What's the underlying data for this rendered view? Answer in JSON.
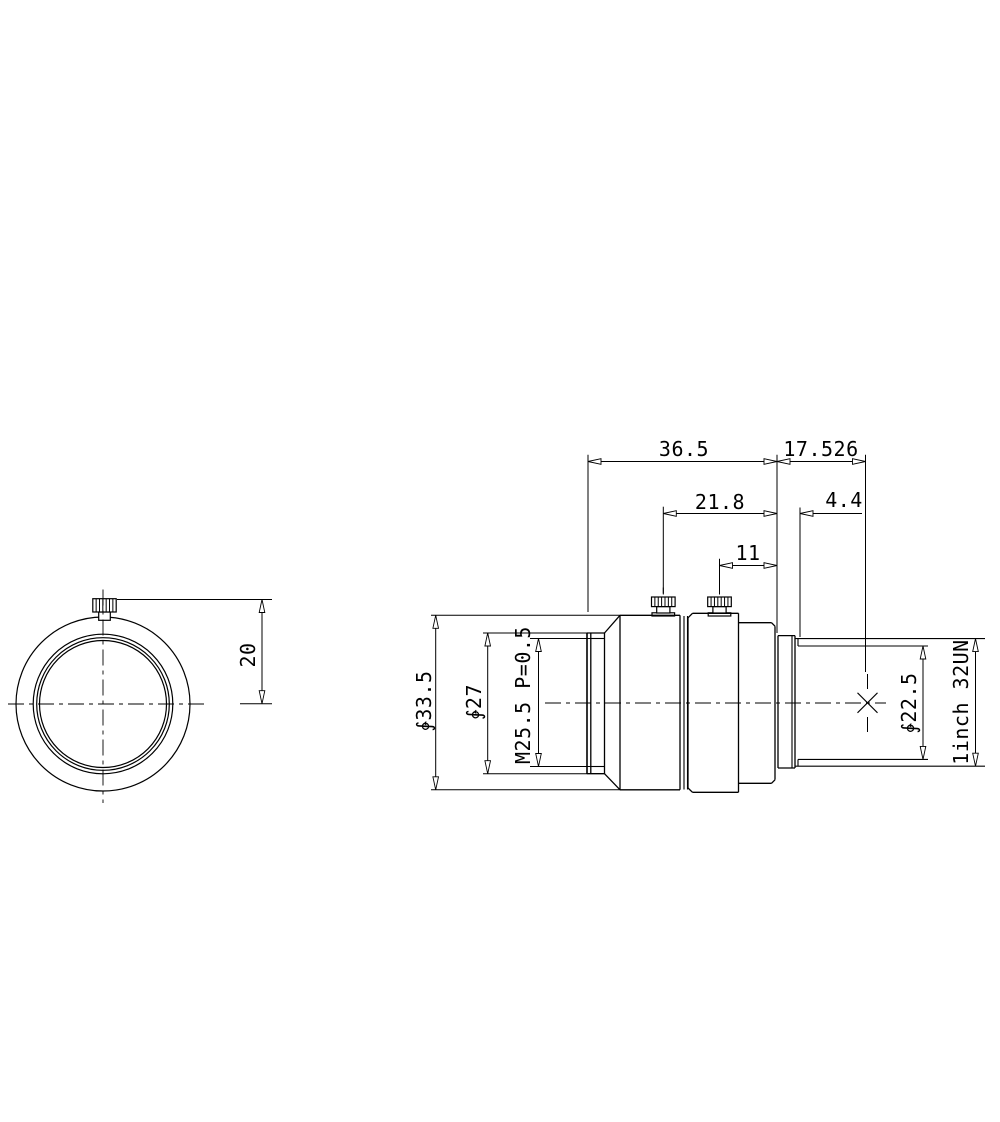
{
  "drawing": {
    "type": "lens mechanical drawing, front view and side view",
    "line_color": "#000000",
    "background": "#ffffff",
    "dimension_labels": [
      "36.5",
      "17.526",
      "21.8",
      "4.4",
      "11",
      "20",
      "∳33.5",
      "∳27",
      "M25.5 P=0.5",
      "∳22.5",
      "1inch 32UN"
    ]
  },
  "svg": {
    "circles": [
      {
        "n": "front-view-outer-rim-circle",
        "cx": 103,
        "cy": 704,
        "r": 87
      },
      {
        "n": "front-view-ring-circle",
        "cx": 103,
        "cy": 704,
        "r": 69.8
      },
      {
        "n": "front-view-thread-circle",
        "cx": 103,
        "cy": 704,
        "r": 66.3
      },
      {
        "n": "front-view-bore-circle",
        "cx": 103,
        "cy": 704,
        "r": 63.5
      }
    ],
    "rects": [
      {
        "n": "front-thumbscrew-neck",
        "x": 98.7,
        "y": 612,
        "w": 11.6,
        "h": 8.3
      },
      {
        "n": "front-thumbscrew-head",
        "x": 92.8,
        "y": 598.7,
        "w": 23.4,
        "h": 13.3,
        "knurl": 6
      },
      {
        "n": "side-thumbscrew1-washer",
        "x": 652,
        "y": 612.8,
        "w": 22.6,
        "h": 3.2
      },
      {
        "n": "side-thumbscrew1-neck",
        "x": 656.7,
        "y": 606.6,
        "w": 13.2,
        "h": 6.4
      },
      {
        "n": "side-thumbscrew1-head",
        "x": 651.5,
        "y": 597,
        "w": 23.6,
        "h": 9.6,
        "knurl": 6
      },
      {
        "n": "side-thumbscrew2-washer",
        "x": 708.2,
        "y": 612.8,
        "w": 22.6,
        "h": 3.2
      },
      {
        "n": "side-thumbscrew2-neck",
        "x": 712.9,
        "y": 606.6,
        "w": 13.2,
        "h": 6.4
      },
      {
        "n": "side-thumbscrew2-head",
        "x": 707.7,
        "y": 597,
        "w": 23.6,
        "h": 9.6,
        "knurl": 6
      }
    ],
    "lines": [
      {
        "n": "front-ring-face-outer",
        "x1": 587,
        "y1": 633,
        "x2": 587,
        "y2": 773.7,
        "w": 1.6
      },
      {
        "n": "front-ring-face-inner",
        "x1": 590.8,
        "y1": 633,
        "x2": 590.8,
        "y2": 773.7,
        "w": 1.3
      },
      {
        "n": "front-ring-right-edge",
        "x1": 604.5,
        "y1": 633,
        "x2": 604.5,
        "y2": 773.7,
        "w": 1.3
      },
      {
        "n": "front-ring-top-edge",
        "x1": 587,
        "y1": 633,
        "x2": 604.5,
        "y2": 633,
        "w": 1.3
      },
      {
        "n": "front-ring-bottom-edge",
        "x1": 587,
        "y1": 773.7,
        "x2": 604.5,
        "y2": 773.7,
        "w": 1.3
      },
      {
        "n": "filter-thread-top-line",
        "x1": 590.8,
        "y1": 638.5,
        "x2": 604.5,
        "y2": 638.5,
        "w": 1.1
      },
      {
        "n": "filter-thread-bottom-line",
        "x1": 590.8,
        "y1": 766.5,
        "x2": 604.5,
        "y2": 766.5,
        "w": 1.1
      },
      {
        "n": "cone-top-edge",
        "x1": 604.5,
        "y1": 633,
        "x2": 620,
        "y2": 615.3,
        "w": 1.3
      },
      {
        "n": "cone-bottom-edge",
        "x1": 604.5,
        "y1": 773.7,
        "x2": 620,
        "y2": 789.8,
        "w": 1.3
      },
      {
        "n": "barrel1-left-edge",
        "x1": 620,
        "y1": 615.3,
        "x2": 620,
        "y2": 789.8,
        "w": 1.3
      },
      {
        "n": "barrel1-top-edge",
        "x1": 620,
        "y1": 615.3,
        "x2": 680,
        "y2": 615.3,
        "w": 1.3
      },
      {
        "n": "barrel1-bottom-edge",
        "x1": 620,
        "y1": 789.8,
        "x2": 680,
        "y2": 789.8,
        "w": 1.3
      },
      {
        "n": "barrel1-right-edge",
        "x1": 680,
        "y1": 615.3,
        "x2": 680,
        "y2": 789.8,
        "w": 1.3
      },
      {
        "n": "mid-ring-left-line",
        "x1": 684,
        "y1": 616,
        "x2": 684,
        "y2": 789.5,
        "w": 1.1
      },
      {
        "n": "mid-ring-right-line",
        "x1": 687.5,
        "y1": 616,
        "x2": 687.5,
        "y2": 789.5,
        "w": 1.1
      },
      {
        "n": "barrel2-left-edge",
        "x1": 688,
        "y1": 617.8,
        "x2": 688,
        "y2": 788,
        "w": 1.3
      },
      {
        "n": "barrel2-chamfer-top-left",
        "x1": 688,
        "y1": 617.8,
        "x2": 692.5,
        "y2": 613.3,
        "w": 1.3
      },
      {
        "n": "barrel2-chamfer-bottom-left",
        "x1": 688,
        "y1": 788,
        "x2": 692.5,
        "y2": 792.3,
        "w": 1.3
      },
      {
        "n": "barrel2-top-edge",
        "x1": 692.5,
        "y1": 613.3,
        "x2": 738.5,
        "y2": 613.3,
        "w": 1.3
      },
      {
        "n": "barrel2-bottom-edge",
        "x1": 692.5,
        "y1": 792.3,
        "x2": 738.5,
        "y2": 792.3,
        "w": 1.3
      },
      {
        "n": "barrel2-right-edge",
        "x1": 738.5,
        "y1": 613.3,
        "x2": 738.5,
        "y2": 792.3,
        "w": 1.3
      },
      {
        "n": "step-section-top-edge",
        "x1": 738.5,
        "y1": 622.7,
        "x2": 771.5,
        "y2": 622.7,
        "w": 1.3
      },
      {
        "n": "step-section-bottom-edge",
        "x1": 738.5,
        "y1": 783.3,
        "x2": 771.5,
        "y2": 783.3,
        "w": 1.3
      },
      {
        "n": "step-chamfer-top-right",
        "x1": 771.5,
        "y1": 622.7,
        "x2": 775,
        "y2": 626.2,
        "w": 1.3
      },
      {
        "n": "step-chamfer-bottom-right",
        "x1": 771.5,
        "y1": 783.3,
        "x2": 775,
        "y2": 779.8,
        "w": 1.3
      },
      {
        "n": "step-section-right-edge",
        "x1": 775,
        "y1": 626.2,
        "x2": 775,
        "y2": 779.8,
        "w": 1.3
      },
      {
        "n": "flange-left-face",
        "x1": 778,
        "y1": 635.6,
        "x2": 778,
        "y2": 768,
        "w": 1.3
      },
      {
        "n": "flange-top-edge",
        "x1": 778,
        "y1": 635.6,
        "x2": 795,
        "y2": 635.6,
        "w": 1.3
      },
      {
        "n": "flange-bottom-edge",
        "x1": 778,
        "y1": 768,
        "x2": 795,
        "y2": 768,
        "w": 1.3
      },
      {
        "n": "flange-inner-line",
        "x1": 792,
        "y1": 635.6,
        "x2": 792,
        "y2": 768,
        "w": 1.1
      },
      {
        "n": "flange-right-face",
        "x1": 795,
        "y1": 635.6,
        "x2": 795,
        "y2": 768,
        "w": 1.3
      },
      {
        "n": "mount-thread-od-top",
        "x1": 795,
        "y1": 638.6,
        "x2": 985,
        "y2": 638.6,
        "w": 1.1
      },
      {
        "n": "mount-thread-od-bottom",
        "x1": 795,
        "y1": 766.2,
        "x2": 985,
        "y2": 766.2,
        "w": 1.1
      },
      {
        "n": "mount-thread-minor-top",
        "x1": 798,
        "y1": 646,
        "x2": 928,
        "y2": 646,
        "w": 1.1
      },
      {
        "n": "mount-thread-minor-bottom",
        "x1": 798,
        "y1": 759.4,
        "x2": 928,
        "y2": 759.4,
        "w": 1.1
      },
      {
        "n": "mount-thread-start-top",
        "x1": 798,
        "y1": 638.6,
        "x2": 798,
        "y2": 646,
        "w": 1.1
      },
      {
        "n": "mount-thread-start-bottom",
        "x1": 798,
        "y1": 759.4,
        "x2": 798,
        "y2": 766.2,
        "w": 1.1
      },
      {
        "n": "image-plane-cross-stroke1",
        "x1": 857.5,
        "y1": 692.8,
        "x2": 877.5,
        "y2": 712.8,
        "w": 1.1
      },
      {
        "n": "image-plane-cross-stroke2",
        "x1": 857.5,
        "y1": 712.8,
        "x2": 877.5,
        "y2": 692.8,
        "w": 1.1
      },
      {
        "n": "image-plane-tick-top",
        "x1": 867.5,
        "y1": 674,
        "x2": 867.5,
        "y2": 689,
        "w": 1
      },
      {
        "n": "image-plane-tick-bottom",
        "x1": 867.5,
        "y1": 717,
        "x2": 867.5,
        "y2": 732,
        "w": 1
      },
      {
        "n": "thumbscrew1-center-tick",
        "x1": 663.3,
        "y1": 587.5,
        "x2": 663.3,
        "y2": 593.5,
        "w": 1
      },
      {
        "n": "thumbscrew2-center-tick",
        "x1": 719.5,
        "y1": 587.5,
        "x2": 719.5,
        "y2": 593.5,
        "w": 1
      },
      {
        "n": "ext-line-front-face",
        "x1": 588,
        "y1": 454.7,
        "x2": 588,
        "y2": 612,
        "w": 1
      },
      {
        "n": "ext-line-flange-face",
        "x1": 777,
        "y1": 454.7,
        "x2": 777,
        "y2": 633,
        "w": 1
      },
      {
        "n": "ext-line-image-plane",
        "x1": 865.5,
        "y1": 454.7,
        "x2": 865.5,
        "y2": 672,
        "w": 1
      },
      {
        "n": "ext-line-thumbscrew1",
        "x1": 663.3,
        "y1": 506.7,
        "x2": 663.3,
        "y2": 594.5,
        "w": 1
      },
      {
        "n": "ext-line-thumbscrew2",
        "x1": 719.5,
        "y1": 558.7,
        "x2": 719.5,
        "y2": 594.5,
        "w": 1
      },
      {
        "n": "ext-line-thread-start",
        "x1": 800,
        "y1": 507.5,
        "x2": 800,
        "y2": 637,
        "w": 1
      },
      {
        "n": "ext-line-d335-top",
        "x1": 431,
        "y1": 615.3,
        "x2": 620,
        "y2": 615.3,
        "w": 1
      },
      {
        "n": "ext-line-d335-bottom",
        "x1": 431,
        "y1": 789.8,
        "x2": 620,
        "y2": 789.8,
        "w": 1
      },
      {
        "n": "ext-line-d27-top",
        "x1": 483,
        "y1": 633,
        "x2": 587,
        "y2": 633,
        "w": 1
      },
      {
        "n": "ext-line-d27-bottom",
        "x1": 483,
        "y1": 773.7,
        "x2": 587,
        "y2": 773.7,
        "w": 1
      },
      {
        "n": "ext-line-m255-top",
        "x1": 530,
        "y1": 638.5,
        "x2": 590.8,
        "y2": 638.5,
        "w": 1
      },
      {
        "n": "ext-line-m255-bottom",
        "x1": 530,
        "y1": 766.5,
        "x2": 590.8,
        "y2": 766.5,
        "w": 1
      },
      {
        "n": "ext-line-20-top",
        "x1": 117,
        "y1": 599.5,
        "x2": 272,
        "y2": 599.5,
        "w": 1
      },
      {
        "n": "ext-line-20-bottom",
        "x1": 240,
        "y1": 703.7,
        "x2": 272,
        "y2": 703.7,
        "w": 1
      },
      {
        "n": "dim-line-36-5",
        "x1": 588,
        "y1": 461.5,
        "x2": 777,
        "y2": 461.5,
        "w": 1
      },
      {
        "n": "dim-line-17-526",
        "x1": 777,
        "y1": 461.5,
        "x2": 865.5,
        "y2": 461.5,
        "w": 1
      },
      {
        "n": "dim-line-21-8",
        "x1": 663.3,
        "y1": 513.5,
        "x2": 777,
        "y2": 513.5,
        "w": 1
      },
      {
        "n": "dim-line-4-4",
        "x1": 800,
        "y1": 513.5,
        "x2": 862,
        "y2": 513.5,
        "w": 1
      },
      {
        "n": "dim-line-11",
        "x1": 719.5,
        "y1": 565.5,
        "x2": 777,
        "y2": 565.5,
        "w": 1
      },
      {
        "n": "dim-line-d33-5",
        "x1": 435.7,
        "y1": 615.3,
        "x2": 435.7,
        "y2": 789.8,
        "w": 1
      },
      {
        "n": "dim-line-d27",
        "x1": 487.7,
        "y1": 633,
        "x2": 487.7,
        "y2": 773.7,
        "w": 1
      },
      {
        "n": "dim-line-m25-5",
        "x1": 538.5,
        "y1": 638.5,
        "x2": 538.5,
        "y2": 766.5,
        "w": 1
      },
      {
        "n": "dim-line-d22-5",
        "x1": 923,
        "y1": 646,
        "x2": 923,
        "y2": 759.4,
        "w": 1
      },
      {
        "n": "dim-line-1inch",
        "x1": 975.5,
        "y1": 638.6,
        "x2": 975.5,
        "y2": 766.2,
        "w": 1
      },
      {
        "n": "dim-line-20",
        "x1": 262,
        "y1": 599.5,
        "x2": 262,
        "y2": 703.7,
        "w": 1
      }
    ],
    "centerlines": [
      {
        "n": "front-view-centerline-horizontal",
        "x1": 8,
        "y1": 704,
        "x2": 206,
        "y2": 704
      },
      {
        "n": "front-view-centerline-vertical",
        "x1": 103,
        "y1": 589.5,
        "x2": 103,
        "y2": 803
      },
      {
        "n": "side-view-centerline-horizontal",
        "x1": 545,
        "y1": 703,
        "x2": 886,
        "y2": 703
      }
    ],
    "arrows": [
      {
        "n": "arrow-36-5-left",
        "x": 588,
        "y": 461.5,
        "dir": "left"
      },
      {
        "n": "arrow-36-5-right",
        "x": 777,
        "y": 461.5,
        "dir": "right"
      },
      {
        "n": "arrow-17-526-left",
        "x": 777,
        "y": 461.5,
        "dir": "left"
      },
      {
        "n": "arrow-17-526-right",
        "x": 865.5,
        "y": 461.5,
        "dir": "right"
      },
      {
        "n": "arrow-21-8-left",
        "x": 663.3,
        "y": 513.5,
        "dir": "left"
      },
      {
        "n": "arrow-21-8-right",
        "x": 777,
        "y": 513.5,
        "dir": "right"
      },
      {
        "n": "arrow-4-4",
        "x": 800,
        "y": 513.5,
        "dir": "left"
      },
      {
        "n": "arrow-11-left",
        "x": 719.5,
        "y": 565.5,
        "dir": "left"
      },
      {
        "n": "arrow-11-right",
        "x": 777,
        "y": 565.5,
        "dir": "right"
      },
      {
        "n": "arrow-d33-5-top",
        "x": 435.7,
        "y": 615.3,
        "dir": "up"
      },
      {
        "n": "arrow-d33-5-bottom",
        "x": 435.7,
        "y": 789.8,
        "dir": "down"
      },
      {
        "n": "arrow-d27-top",
        "x": 487.7,
        "y": 633,
        "dir": "up"
      },
      {
        "n": "arrow-d27-bottom",
        "x": 487.7,
        "y": 773.7,
        "dir": "down"
      },
      {
        "n": "arrow-m25-5-top",
        "x": 538.5,
        "y": 638.5,
        "dir": "up"
      },
      {
        "n": "arrow-m25-5-bottom",
        "x": 538.5,
        "y": 766.5,
        "dir": "down"
      },
      {
        "n": "arrow-d22-5-top",
        "x": 923,
        "y": 646,
        "dir": "up"
      },
      {
        "n": "arrow-d22-5-bottom",
        "x": 923,
        "y": 759.4,
        "dir": "down"
      },
      {
        "n": "arrow-1inch-top",
        "x": 975.5,
        "y": 638.6,
        "dir": "up"
      },
      {
        "n": "arrow-1inch-bottom",
        "x": 975.5,
        "y": 766.2,
        "dir": "down"
      },
      {
        "n": "arrow-20-top",
        "x": 262,
        "y": 599.5,
        "dir": "up"
      },
      {
        "n": "arrow-20-bottom",
        "x": 262,
        "y": 703.7,
        "dir": "down"
      }
    ],
    "texts": [
      {
        "n": "dim-text-36-5",
        "s": "36.5",
        "x": 684,
        "y": 456,
        "rot": 0
      },
      {
        "n": "dim-text-17-526",
        "s": "17.526",
        "x": 821,
        "y": 456,
        "rot": 0
      },
      {
        "n": "dim-text-21-8",
        "s": "21.8",
        "x": 720,
        "y": 509,
        "rot": 0
      },
      {
        "n": "dim-text-4-4",
        "s": "4.4",
        "x": 844,
        "y": 507,
        "rot": 0
      },
      {
        "n": "dim-text-11",
        "s": "11",
        "x": 748,
        "y": 560,
        "rot": 0
      },
      {
        "n": "dim-text-20",
        "s": "20",
        "x": 248,
        "y": 655,
        "rot": -90
      },
      {
        "n": "dim-text-d33-5",
        "s": "∳33.5",
        "x": 424,
        "y": 701,
        "rot": -90
      },
      {
        "n": "dim-text-d27",
        "s": "∳27",
        "x": 474,
        "y": 702,
        "rot": -90
      },
      {
        "n": "dim-text-m25-5",
        "s": "M25.5 P=0.5",
        "x": 523,
        "y": 695,
        "rot": -90
      },
      {
        "n": "dim-text-d22-5",
        "s": "∳22.5",
        "x": 909,
        "y": 703,
        "rot": -90
      },
      {
        "n": "dim-text-1inch-32un",
        "s": "1inch 32UN",
        "x": 961,
        "y": 702,
        "rot": -90
      }
    ]
  }
}
